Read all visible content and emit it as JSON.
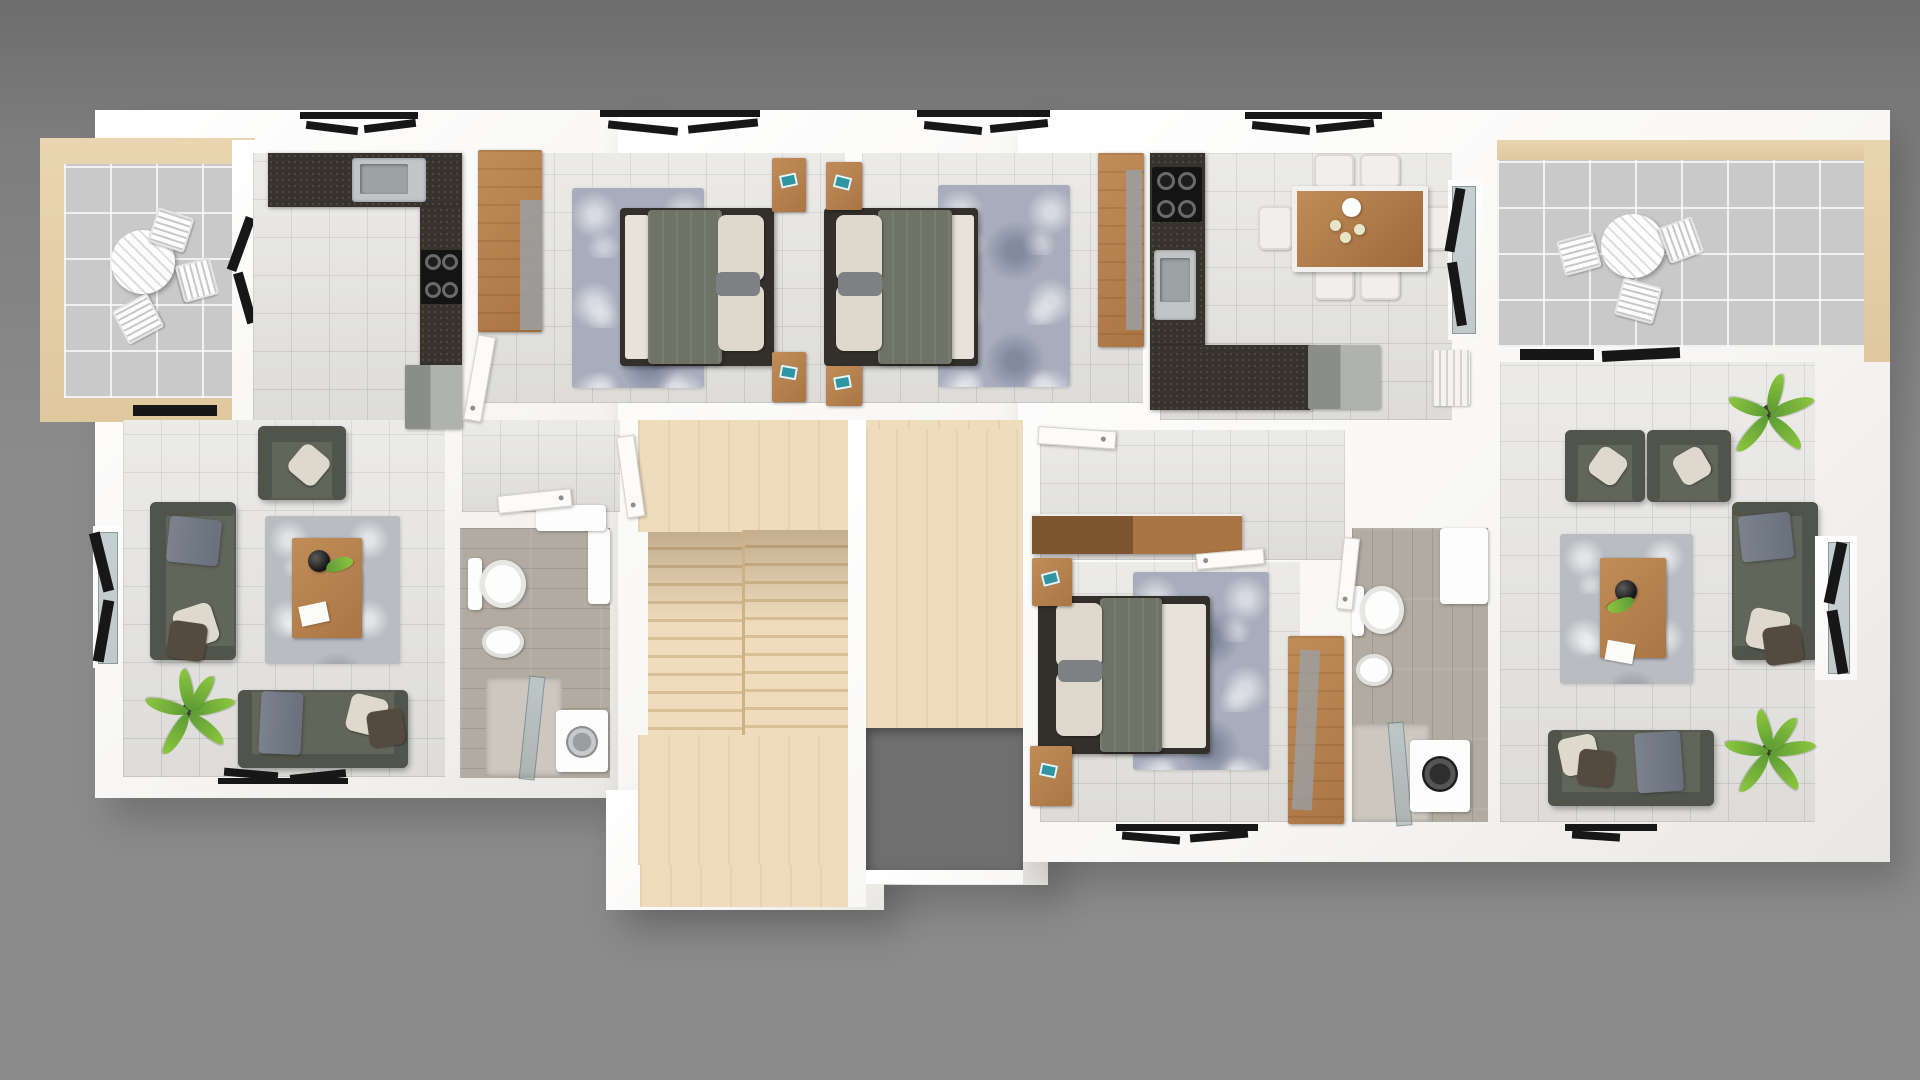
{
  "meta": {
    "render_type": "3d-top-down-floor-plan",
    "canvas": {
      "width": 1920,
      "height": 1080
    },
    "description": "Photorealistic top-view 3D floor plan of one storey with two mirrored apartments around a central staircase"
  },
  "palette": {
    "bg_top": "#6d6d6d",
    "bg": "#8b8b8b",
    "wall": "#f8f7f5",
    "wall_shade": "#e9e7e3",
    "tile": "#e6e5e2",
    "tile_line": "rgba(150,150,150,0.28)",
    "balcony_tile": "#c9c9c9",
    "balcony_line": "rgba(255,255,255,0.75)",
    "balcony_frame": "#e9d5b0",
    "stair_wood": "#eedcbd",
    "stair_tread": "#d9bf94",
    "void": "#6f6f6f",
    "granite": "#37322c",
    "steel": "#c2c5c6",
    "steel_dark": "#9da2a4",
    "wood": "#aa7544",
    "wood_light": "#c08d58",
    "wood_dark": "#7d552f",
    "sofa": "#61655a",
    "sofa_dark": "#50544a",
    "pillow": "#ded9cc",
    "pillow_dark": "#554a40",
    "blanket": "#7b828e",
    "bed_frame": "#332f2b",
    "mattress": "#e7e3da",
    "bed_blanket": "#6f7365",
    "rug_bed": "#a7adbc",
    "rug_living": "#b9bcc1",
    "plant": "#5d9b35",
    "plant_light": "#8cc63f",
    "bath_floor": "#b1aba1",
    "glass": "#b9c7c9",
    "white_obj": "#fdfdfd",
    "frame_black": "#171717",
    "gray_cab": "#b0b2ae",
    "teal": "#2f95a3"
  },
  "scene": {
    "left_balcony": {
      "furniture": [
        "round-bistro-table",
        "chair",
        "chair",
        "chair"
      ]
    },
    "left_kitchen": {
      "furniture": [
        "l-shaped-granite-counter",
        "sink",
        "cooktop-4-burner",
        "wardrobe",
        "tv-cabinet"
      ]
    },
    "left_living_room": {
      "furniture": [
        "armchair",
        "sofa-2-seat",
        "sofa-3-seat",
        "rug",
        "coffee-table",
        "vase",
        "magazine",
        "plant"
      ]
    },
    "left_bathroom": {
      "furniture": [
        "toilet",
        "sink",
        "shower",
        "washing-machine",
        "wall-cabinet"
      ]
    },
    "bedroom_1": {
      "furniture": [
        "double-bed",
        "rug",
        "nightstand",
        "nightstand",
        "wardrobe"
      ]
    },
    "bedroom_2": {
      "furniture": [
        "double-bed",
        "rug",
        "nightstand",
        "nightstand",
        "wardrobe"
      ]
    },
    "bedroom_3": {
      "furniture": [
        "double-bed",
        "rug",
        "nightstand",
        "nightstand",
        "wardrobe",
        "hall-console"
      ]
    },
    "right_kitchen_dining": {
      "furniture": [
        "l-shaped-granite-counter",
        "sink",
        "cooktop-4-burner",
        "dining-table-6-seats",
        "tea-set",
        "tv-cabinet",
        "radiator"
      ]
    },
    "right_living_room": {
      "furniture": [
        "armchair",
        "armchair",
        "sofa-2-seat",
        "sofa-3-seat",
        "rug",
        "coffee-table",
        "vase",
        "plant",
        "plant"
      ]
    },
    "right_bathroom": {
      "furniture": [
        "toilet",
        "sink",
        "shower",
        "washing-machine",
        "wall-cabinet"
      ]
    },
    "right_balcony": {
      "furniture": [
        "round-bistro-table",
        "chair",
        "chair",
        "chair"
      ]
    },
    "stairwell": {
      "parts": [
        "upper-landing",
        "flight-left",
        "flight-right",
        "lower-landing",
        "entry-platform",
        "stair-void"
      ]
    },
    "openings": [
      "windows-black-frames",
      "balcony-sliding-doors",
      "interior-doors-white"
    ]
  }
}
